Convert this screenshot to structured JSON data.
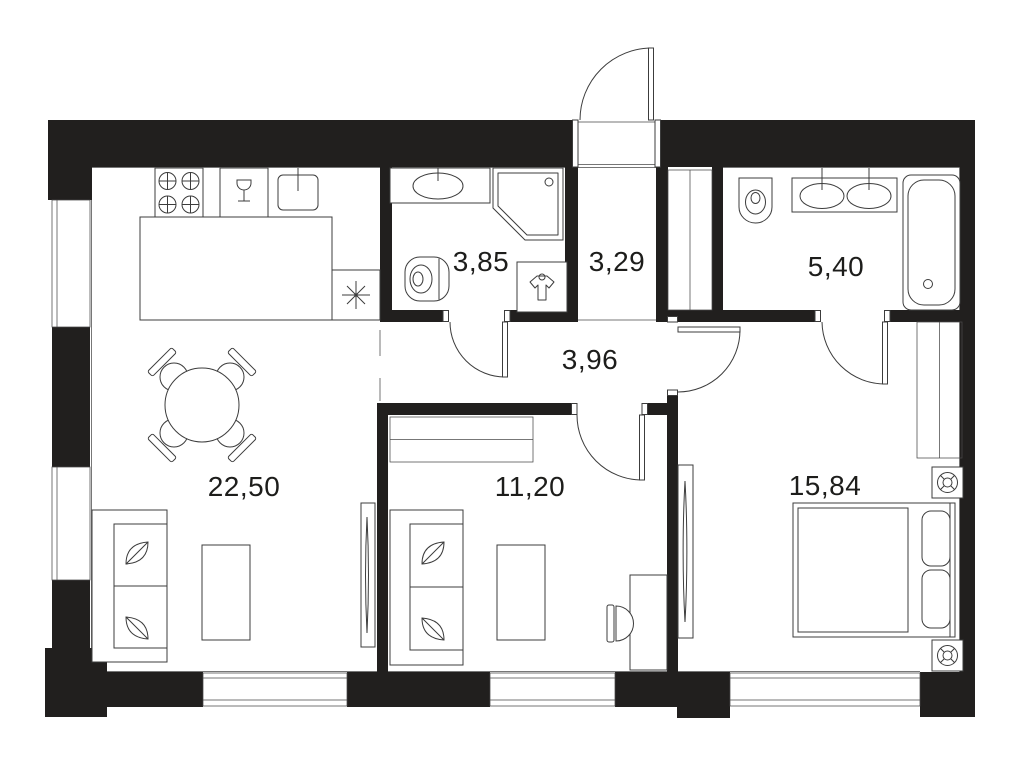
{
  "plan": {
    "rooms": [
      {
        "id": "kitchen-living-room",
        "area": "22,50"
      },
      {
        "id": "bedroom-small",
        "area": "11,20"
      },
      {
        "id": "bedroom-master",
        "area": "15,84"
      },
      {
        "id": "bathroom",
        "area": "3,85"
      },
      {
        "id": "entrance-hall",
        "area": "3,29"
      },
      {
        "id": "bathroom-ensuite",
        "area": "5,40"
      },
      {
        "id": "corridor",
        "area": "3,96"
      }
    ],
    "colors": {
      "wall": "#211f1e",
      "line": "#3c3c3c",
      "label": "#1d1d1b",
      "background": "#ffffff"
    }
  }
}
